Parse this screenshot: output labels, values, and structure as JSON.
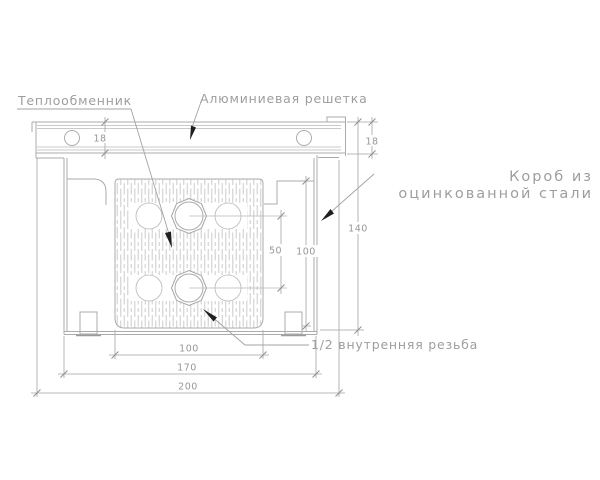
{
  "drawing": {
    "title": "Convector cross-section technical drawing",
    "labels": {
      "heat_exchanger": "Теплообменник",
      "aluminum_grille": "Алюминиевая решетка",
      "box_line1": "Короб из",
      "box_line2": "оцинкованной стали",
      "thread": "1/2 внутренняя резьба"
    },
    "dimensions": {
      "grille_height_left": "18",
      "grille_height_right": "18",
      "overall_height": "140",
      "inner_height": "100",
      "pipe_spacing": "50",
      "exchanger_width": "100",
      "inner_width": "170",
      "overall_width": "200"
    },
    "colors": {
      "line": "#ababab",
      "text": "#9e9e9e",
      "arrow": "#1f1f1f",
      "hatch": "#c4c4c4",
      "background": "#ffffff"
    }
  }
}
